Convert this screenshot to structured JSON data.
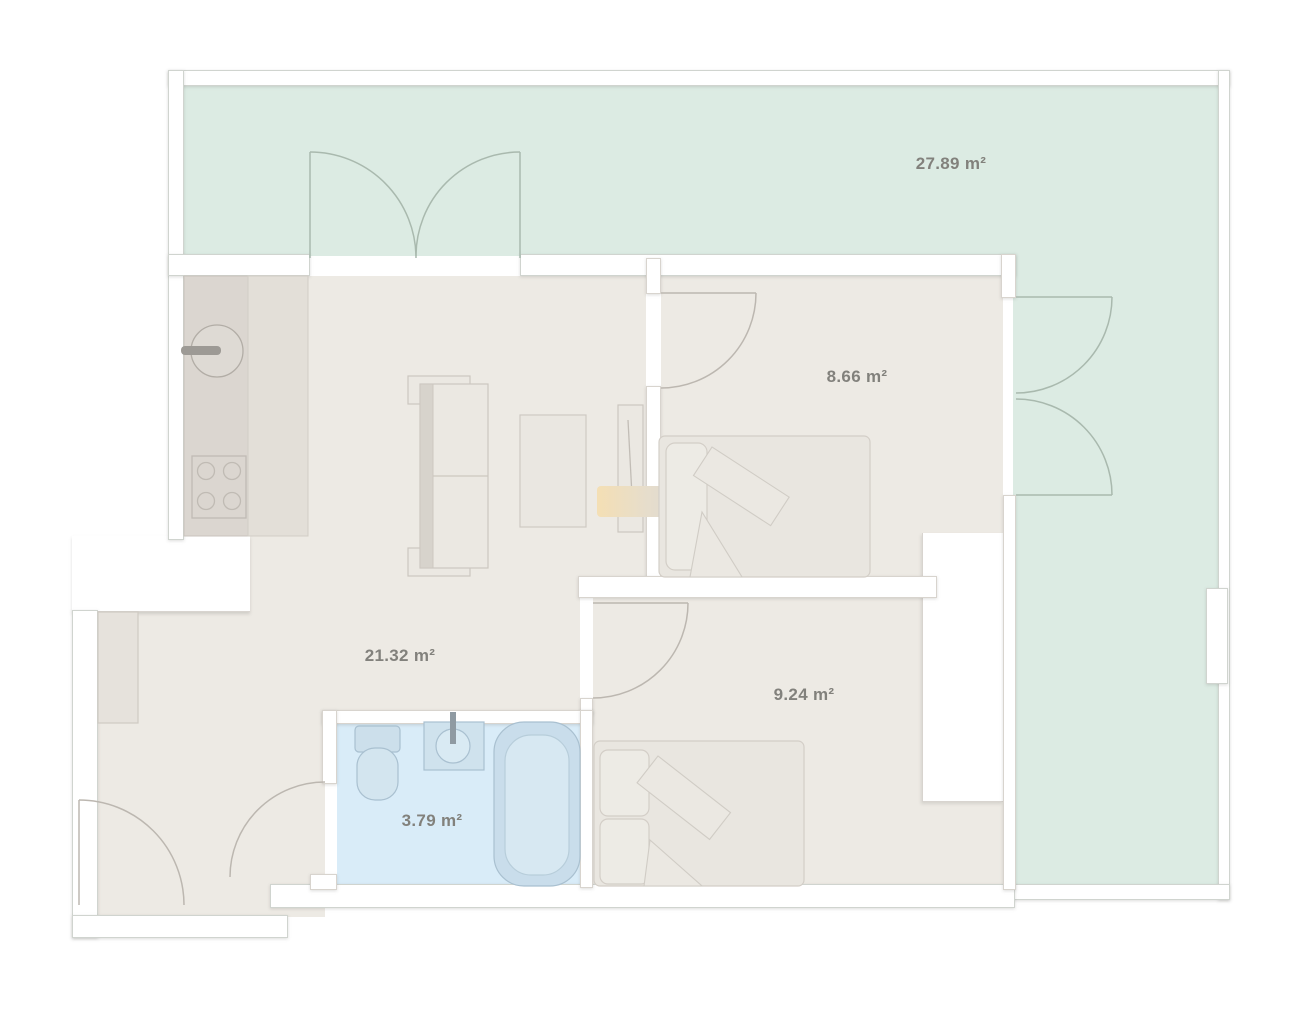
{
  "plan": {
    "type": "apartment-floor-plan",
    "rooms": [
      {
        "id": "terrace",
        "area_label": "27.89 m²"
      },
      {
        "id": "bedroom-1",
        "area_label": "8.66 m²"
      },
      {
        "id": "living-room",
        "area_label": "21.32 m²"
      },
      {
        "id": "bedroom-2",
        "area_label": "9.24 m²"
      },
      {
        "id": "bathroom",
        "area_label": "3.79 m²"
      }
    ],
    "colors": {
      "terrace_floor": "#dcebe3",
      "interior_floor": "#edeae4",
      "bathroom_floor": "#d9ecf8",
      "wall": "#ffffff",
      "wall_outline": "#d0d4cf",
      "label_text": "#82817c",
      "fixture_outline": "#a9c0d0",
      "furniture_outline": "#d0ccc5",
      "sideboard_accent": "#f4dfb4"
    }
  }
}
